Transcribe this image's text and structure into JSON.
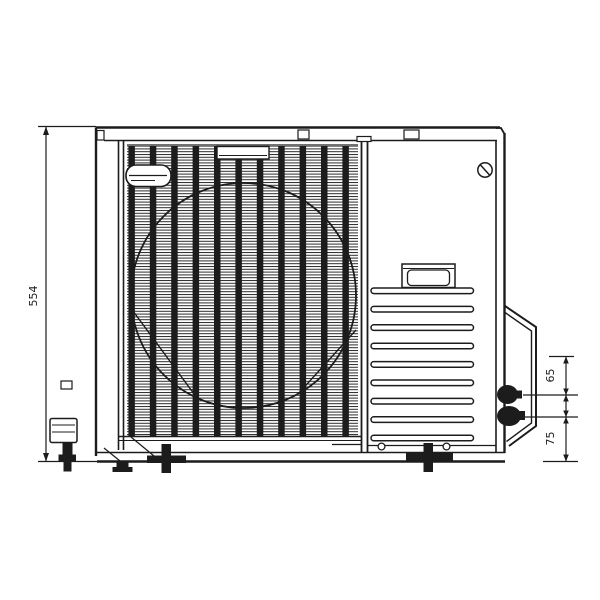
{
  "drawing": {
    "title": "outdoor-unit-dimensional-drawing",
    "dimensions": {
      "height": {
        "value": "554"
      },
      "right_upper": {
        "value": "65"
      },
      "right_lower": {
        "value": "75"
      }
    },
    "colors": {
      "line": "#1c1c1c",
      "background": "#ffffff"
    }
  }
}
